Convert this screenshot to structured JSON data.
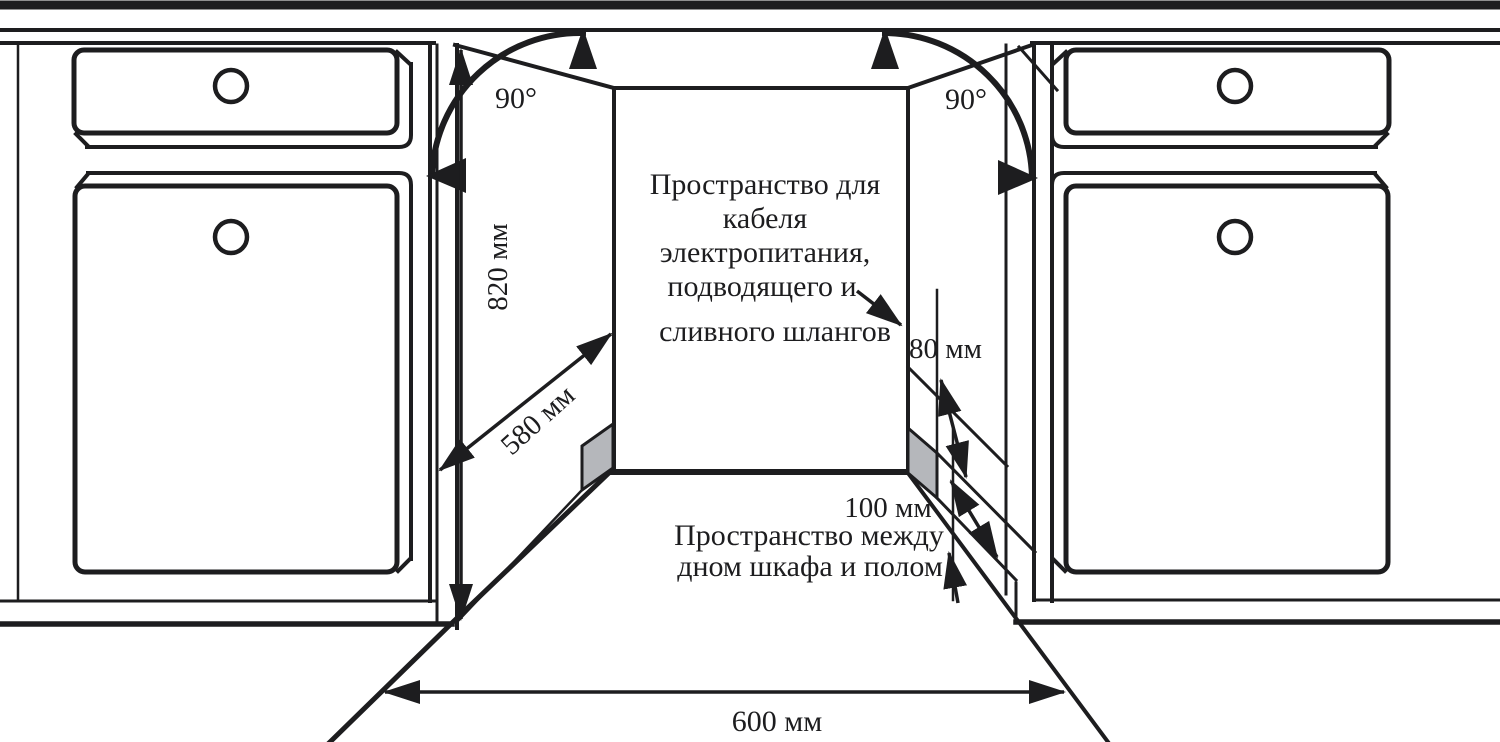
{
  "diagram": {
    "type": "installation-drawing",
    "subject": "built-in appliance niche between kitchen cabinets",
    "units": "мм"
  },
  "colors": {
    "ink": "#1d1d1f",
    "panel_gray": "#b5b7bb",
    "background": "#ffffff"
  },
  "labels": {
    "angle_left": "90°",
    "angle_right": "90°",
    "height": "820 мм",
    "depth": "580 мм",
    "width": "600 мм",
    "cable_gap": "80 мм",
    "floor_gap": "100 мм",
    "cable_space": [
      "Пространство для",
      "кабеля",
      "электропитания,",
      "подводящего и",
      "сливного шлангов"
    ],
    "floor_space": [
      "Пространство между",
      "дном шкафа и полом"
    ]
  }
}
